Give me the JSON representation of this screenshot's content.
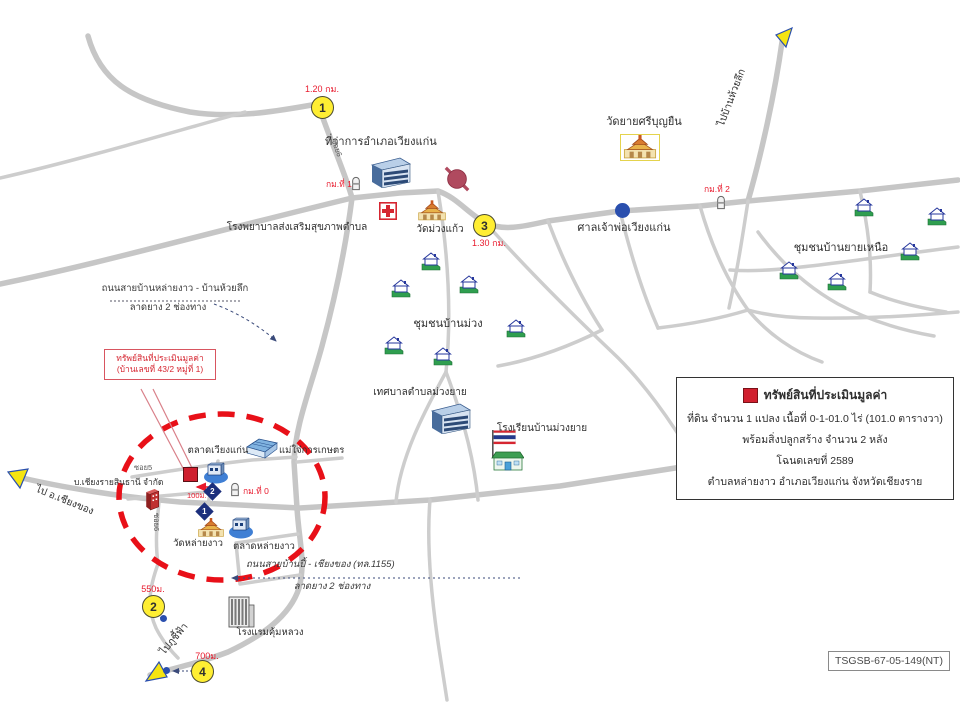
{
  "doc_ref": "TSGSB-67-05-149(NT)",
  "colors": {
    "road": "#c8c8c8",
    "distance_red": "#e8192c",
    "marker_yellow": "#ffee33",
    "property_red": "#cf1f2e",
    "diamond_blue": "#1c2f7c",
    "ellipse_red": "#e81018",
    "shrine_blue": "#2a4fae"
  },
  "legend": {
    "title": "ทรัพย์สินที่ประเมินมูลค่า",
    "line1": "ที่ดิน จำนวน 1 แปลง เนื้อที่ 0-1-01.0 ไร่ (101.0 ตารางวา)",
    "line2": "พร้อมสิ่งปลูกสร้าง จำนวน 2 หลัง",
    "line3": "โฉนดเลขที่ 2589",
    "line4": "ตำบลหล่ายงาว อำเภอเวียงแก่น จังหวัดเชียงราย"
  },
  "property_callout": {
    "line1": "ทรัพย์สินที่ประเมินมูลค่า",
    "line2": "(บ้านเลขที่ 43/2 หมู่ที่ 1)"
  },
  "places": {
    "district_office": "ที่ว่าการอำเภอเวียงแก่น",
    "health_center": "โรงพยาบาลส่งเสริมสุขภาพตำบล",
    "wat_muang_kaew": "วัดม่วงแก้ว",
    "wat_yai_sribunyuen": "วัดยายศรีบุญยืน",
    "shrine": "ศาลเจ้าพ่อเวียงแก่น",
    "community_yai_nuea": "ชุมชนบ้านยายเหนือ",
    "community_ban_muang": "ชุมชนบ้านม่วง",
    "municipality": "เทศบาลตำบลม่วงยาย",
    "school": "โรงเรียนบ้านม่วงยาย",
    "market_wiang_kaen": "ตลาดเวียงแก่น",
    "agri_shop": "แม่ใจ๋การเกษตร",
    "company": "บ.เชียงรายสินธานี จำกัด",
    "wat_lai_ngao": "วัดหล่ายงาว",
    "market_lai_ngao": "ตลาดหล่ายงาว",
    "hotel": "โรงแรมคุ้มหลวง"
  },
  "roads": {
    "north_road_name": "ถนนสายบ้านหล่ายงาว - บ้านห้วยลึก",
    "north_road_detail": "ลาดยาง 2 ช่องทาง",
    "south_road_name": "ถนนสายบ้านปี้ - เชียงของ (ทล.1155)",
    "south_road_detail": "ลาดยาง 2 ช่องทาง",
    "soi5": "ซอย5",
    "soi6": "ซอย6",
    "soi_top": "ซอย6"
  },
  "directions": {
    "to_chiang_khong": "ไป อ.เชียงของ",
    "to_phu_chi_fa": "ไปภูชี้ฟ้า",
    "to_ban_huai_luek": "ไปบ้านห้วยลึก"
  },
  "distance_markers": [
    {
      "no": "1",
      "distance": "1.20 กม."
    },
    {
      "no": "2",
      "distance": "550ม."
    },
    {
      "no": "3",
      "distance": "1.30 กม."
    },
    {
      "no": "4",
      "distance": "700ม."
    }
  ],
  "near_distance": "100ม.",
  "km_posts": {
    "km0": "กม.ที่ 0",
    "km1": "กม.ที่ 1",
    "km2": "กม.ที่ 2"
  },
  "junction_markers": [
    {
      "no": "2"
    },
    {
      "no": "1"
    }
  ]
}
